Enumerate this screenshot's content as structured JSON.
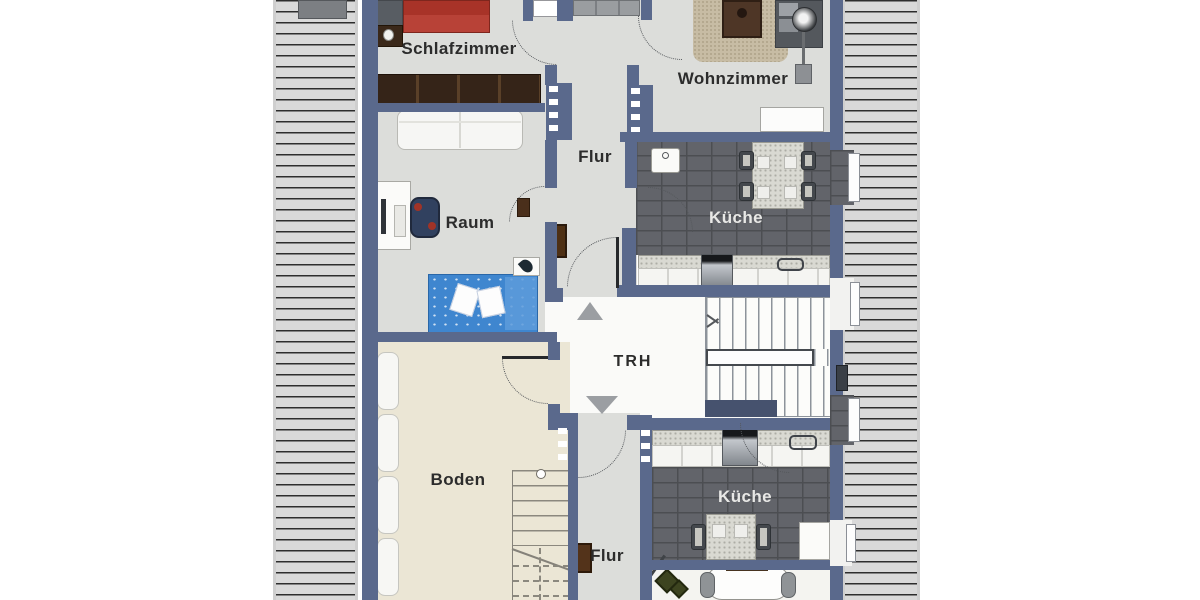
{
  "plan": {
    "type": "floor-plan",
    "language": "de",
    "rooms": {
      "schlafzimmer": "Schlafzimmer",
      "wohnzimmer": "Wohnzimmer",
      "flur_upper": "Flur",
      "kueche_upper": "Küche",
      "raum": "Raum",
      "trh": "TRH",
      "boden": "Boden",
      "kueche_lower": "Küche",
      "flur_lower": "Flur"
    },
    "icons": {
      "stairs_up": "triangle-up-icon",
      "stairs_down": "triangle-down-icon",
      "stair_walkline": "arrow-left-icon"
    },
    "colors": {
      "wall": "#5a698c",
      "floor": "#dcddda",
      "attic_floor": "#ebe6d5",
      "stairwell_floor": "#fafaf8",
      "kitchen_tile": "#62646a",
      "tile_grout": "#4c4e52",
      "roof_hatch": "#d9d9d9",
      "hatch_line": "#2d2d2d",
      "bed_red": "#b23a2f",
      "kids_bed_blue": "#3f86cf",
      "wood_dark": "#38271a",
      "rug_beige": "#c7bca4",
      "label_text": "#2c2c2c"
    }
  }
}
